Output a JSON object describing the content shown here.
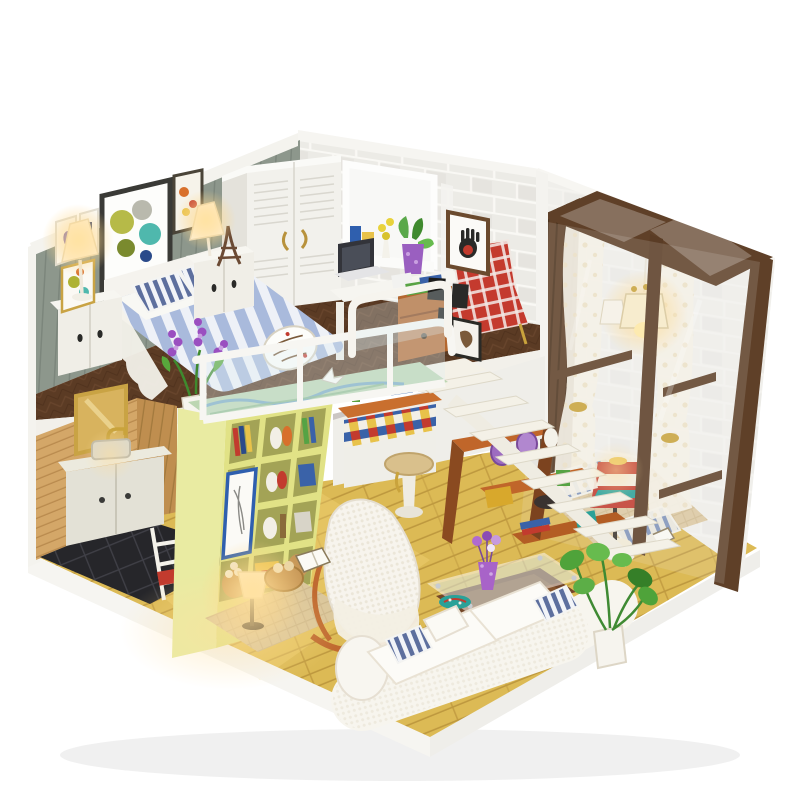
{
  "meta": {
    "title": "DIY miniature dollhouse loft diorama product photo",
    "scene_type": "photograph of a miniature two-level loft apartment kit on a white background"
  },
  "palette": {
    "page_bg": "#ffffff",
    "left_wall": "#8d978c",
    "wall_trim": "#f4f3ee",
    "brick_wall": "#ecebe6",
    "far_wall": "#f0efeb",
    "loft_floor": "#5b3b24",
    "lower_floor": "#dcba55",
    "kitchen_wall": "#d4a768",
    "kitchen_back_wall": "#bf8e4f",
    "kitchen_tile": "#26262a",
    "vanity": "#e3e1d6",
    "mirror_gold": "#c9a344",
    "bookshelf_front": "#e1e286",
    "bookshelf_side": "#e9eba2",
    "bookshelf_inner": "#a3a356",
    "stairs": "#f4f1e7",
    "understair_shelf": "#c0662a",
    "conservatory_frame": "#5f4028",
    "curtain": "#f5f1e6",
    "mat": "#ddc9a2",
    "sofa": "#f7f5ee",
    "seat_cushion": "#fcfbf7",
    "pillow_stripe": "#5d6f9e",
    "blanket_stripe": "#a9badc",
    "red_chair": "#c43a2e",
    "coffee_table": "#744628",
    "glass_tint": "#dff0f4",
    "plant_green": "#4fa33a",
    "purple_vase": "#a863c8",
    "teal_plate": "#2aa198",
    "lamp_glow": "#ffdf9e",
    "wardrobe": "#f2f1ec",
    "desk_drawers": "#b4672f",
    "laptop": "#33343a",
    "platform": "#f6f5f1"
  },
  "scene": {
    "rooms": [
      "loft-bedroom",
      "desk-nook",
      "kitchen-bath-nook",
      "living-room",
      "glass-conservatory"
    ],
    "objects": [
      "striped-bed",
      "script-patch-blanket",
      "striped-pillows",
      "white-headboard",
      "nightstand-left",
      "nightstand-right",
      "bedside-lamp-left",
      "bedside-lamp-right",
      "eiffel-tower-figurine",
      "lavender-pot",
      "wall-art-circles",
      "ballerina-frame",
      "white-louvered-wardrobe",
      "back-window-with-plants",
      "desk-with-laptop",
      "red-plaid-armchair",
      "handprint-frame",
      "horse-photo-frame",
      "glass-balcony-railing",
      "map-art-balcony-top",
      "yellow-cubby-bookshelf",
      "floating-white-stairs",
      "understair-orange-shelves",
      "wicker-stool",
      "mosaic-tile-counter",
      "gold-framed-mirror",
      "sink-vanity",
      "ladder-rack",
      "black-tile-floor",
      "glowing-floor-lamp",
      "bread-basket",
      "rocking-lounge-chair",
      "knit-throw",
      "glass-top-coffee-table",
      "purple-flower-vase",
      "teal-plate",
      "white-corner-sofa",
      "striped-sofa-pillows",
      "potted-monstera",
      "dark-wood-conservatory",
      "sheer-dot-curtains",
      "pendant-light",
      "patterned-table-lamp",
      "floor-cushions",
      "open-book",
      "white-display-base"
    ],
    "lighting": [
      "warm-led-bedside-lamps",
      "warm-pendant-glow",
      "warm-floor-lamp-glow"
    ]
  }
}
